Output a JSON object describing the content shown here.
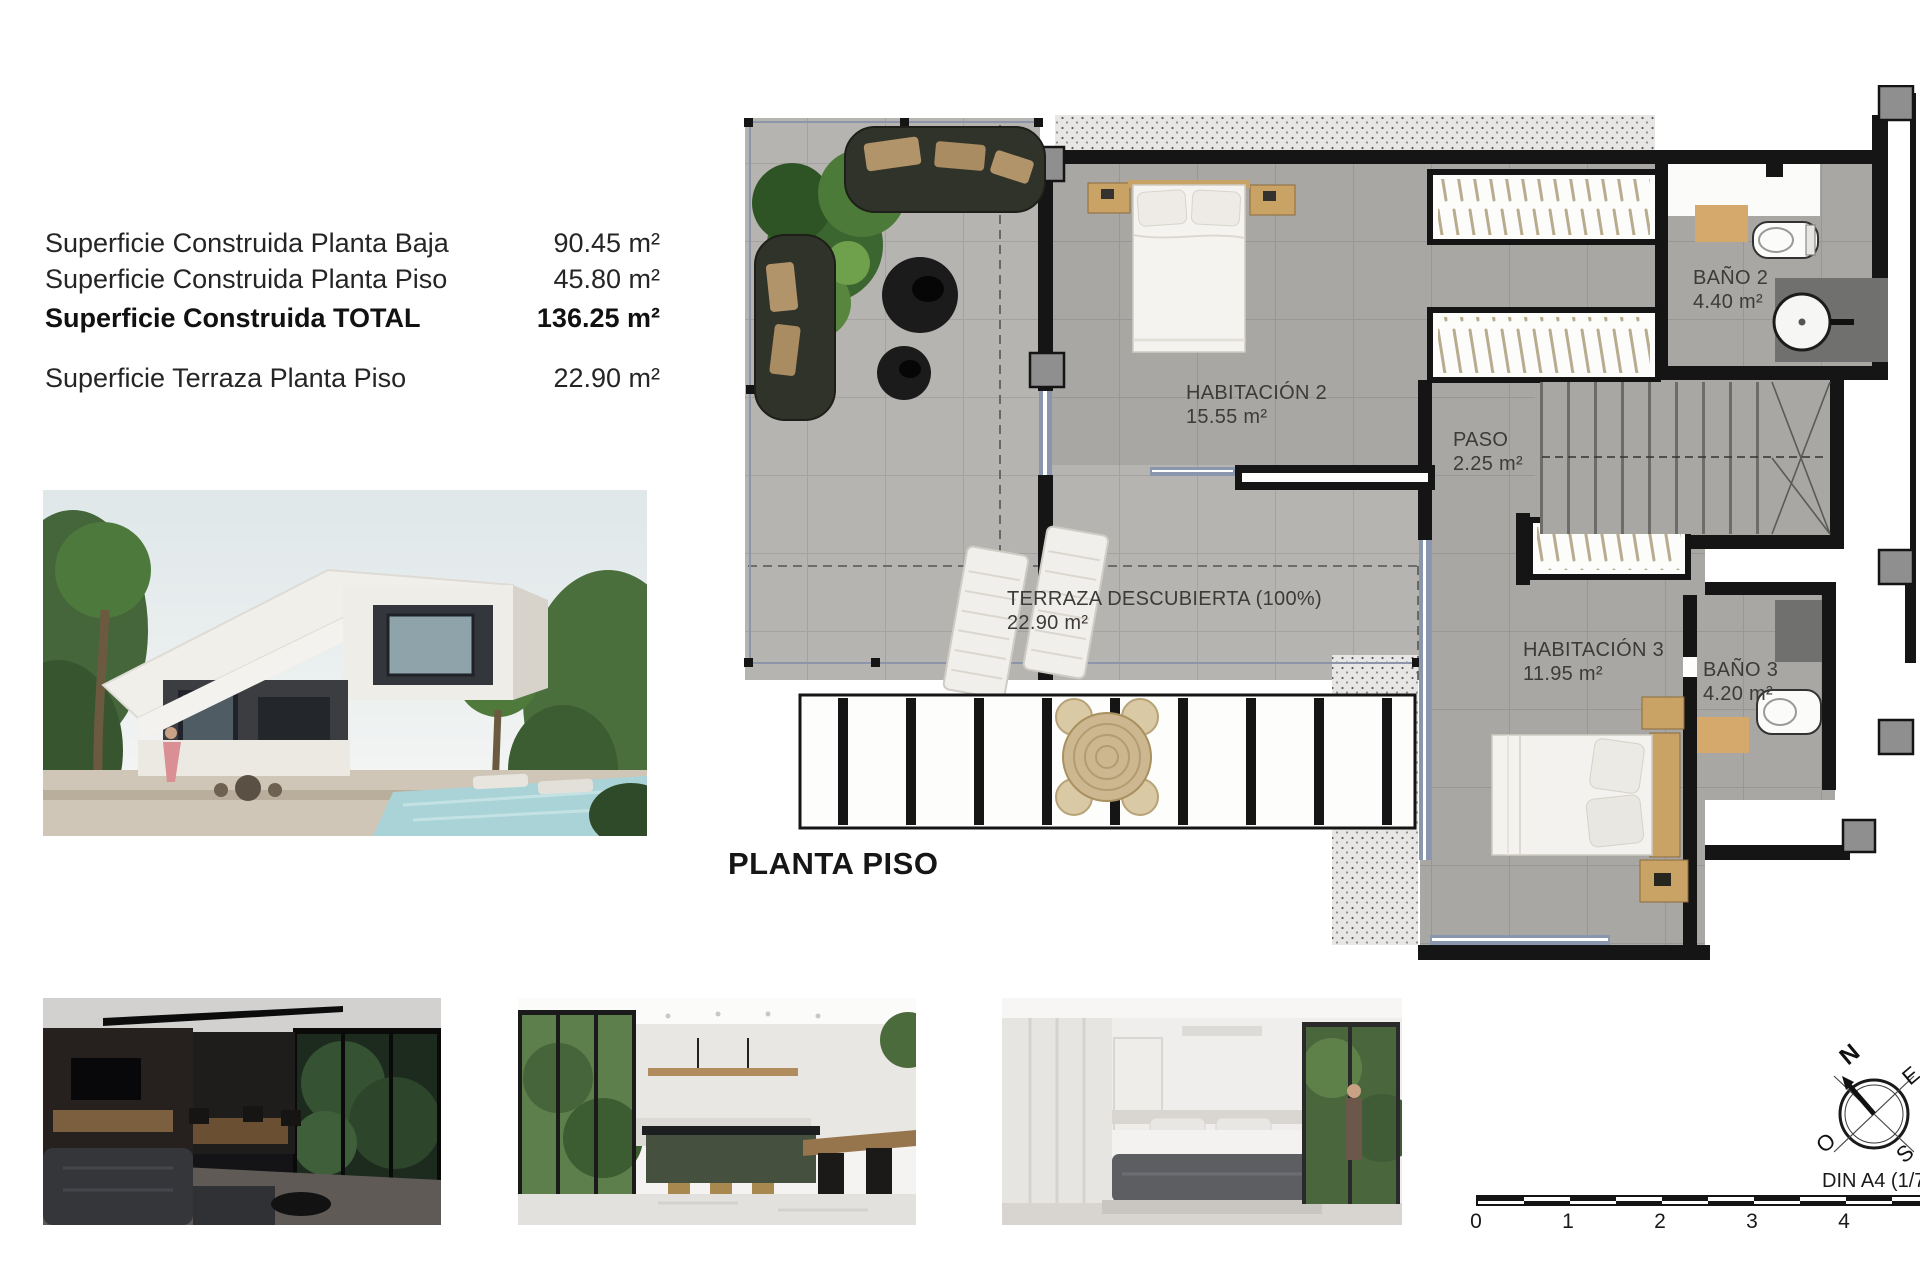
{
  "surface_table": {
    "rows": [
      {
        "label": "Superficie Construida Planta Baja",
        "value": "90.45 m²"
      },
      {
        "label": "Superficie Construida Planta Piso",
        "value": "45.80 m²"
      },
      {
        "label": "Superficie Construida TOTAL",
        "value": "136.25 m²"
      },
      {
        "label": "Superficie Terraza Planta Piso",
        "value": "22.90 m²"
      }
    ]
  },
  "plan": {
    "title": "PLANTA PISO",
    "rooms": {
      "habitacion2": {
        "name": "HABITACIÓN 2",
        "area": "15.55 m²"
      },
      "paso": {
        "name": "PASO",
        "area": "2.25 m²"
      },
      "bano2": {
        "name": "BAÑO 2",
        "area": "4.40 m²"
      },
      "habitacion3": {
        "name": "HABITACIÓN 3",
        "area": "11.95 m²"
      },
      "bano3": {
        "name": "BAÑO 3",
        "area": "4.20 m²"
      },
      "terraza": {
        "name": "TERRAZA DESCUBIERTA (100%)",
        "area": "22.90 m²"
      }
    }
  },
  "scale_bar": {
    "ticks": [
      "0",
      "1",
      "2",
      "3",
      "4"
    ],
    "sheet_label": "DIN A4 (1/75"
  },
  "compass": {
    "north": "N",
    "south": "S",
    "east": "E",
    "west": "O"
  },
  "colors": {
    "wall": "#151515",
    "floor_interior": "#a9a7a4",
    "floor_terrace": "#b6b4b1",
    "wood": "#c9a265",
    "window_frame": "#8a96ad"
  }
}
